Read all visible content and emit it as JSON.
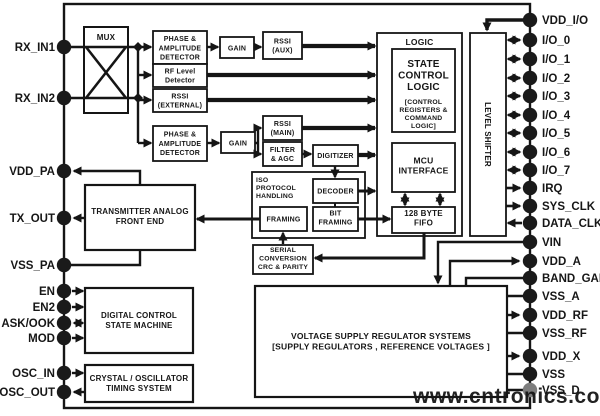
{
  "blocks": {
    "mux": [
      "MUX"
    ],
    "phase_amp_detector_top": [
      "PHASE &",
      "AMPLITUDE",
      "DETECTOR"
    ],
    "gain_top": [
      "GAIN"
    ],
    "rssi_aux": [
      "RSSI",
      "(AUX)"
    ],
    "rf_level_detector": [
      "RF Level",
      "Detector"
    ],
    "rssi_external": [
      "RSSI",
      "(EXTERNAL)"
    ],
    "phase_amp_detector_bottom": [
      "PHASE &",
      "AMPLITUDE",
      "DETECTOR"
    ],
    "gain_bottom": [
      "GAIN"
    ],
    "rssi_main": [
      "RSSI",
      "(MAIN)"
    ],
    "filter_agc": [
      "FILTER",
      "& AGC"
    ],
    "digitizer": [
      "DIGITIZER"
    ],
    "logic_title": [
      "LOGIC"
    ],
    "state_control_logic": [
      "STATE",
      "CONTROL",
      "LOGIC"
    ],
    "scl_sub": [
      "[CONTROL",
      "REGISTERS &",
      "COMMAND",
      "LOGIC]"
    ],
    "mcu_interface": [
      "MCU",
      "INTERFACE"
    ],
    "fifo": [
      "128 BYTE",
      "FIFO"
    ],
    "level_shifter": [
      "LEVEL SHIFTER"
    ],
    "iso_label": [
      "ISO",
      "PROTOCOL",
      "HANDLING"
    ],
    "decoder": [
      "DECODER"
    ],
    "bit_framing": [
      "BIT",
      "FRAMING"
    ],
    "framing": [
      "FRAMING"
    ],
    "serial_conversion": [
      "SERIAL",
      "CONVERSION",
      "CRC & PARITY"
    ],
    "tafe": [
      "TRANSMITTER ANALOG",
      "FRONT END"
    ],
    "dcsm": [
      "DIGITAL CONTROL",
      "STATE MACHINE"
    ],
    "xtal": [
      "CRYSTAL / OSCILLATOR",
      "TIMING SYSTEM"
    ],
    "vreg": [
      "VOLTAGE SUPPLY REGULATOR SYSTEMS",
      "[SUPPLY REGULATORS , REFERENCE VOLTAGES ]"
    ]
  },
  "pins": {
    "left": [
      "RX_IN1",
      "RX_IN2",
      "VDD_PA",
      "TX_OUT",
      "VSS_PA",
      "EN",
      "EN2",
      "ASK/OOK",
      "MOD",
      "OSC_IN",
      "OSC_OUT"
    ],
    "right": [
      "VDD_I/O",
      "I/O_0",
      "I/O_1",
      "I/O_2",
      "I/O_3",
      "I/O_4",
      "I/O_5",
      "I/O_6",
      "I/O_7",
      "IRQ",
      "SYS_CLK",
      "DATA_CLK",
      "VIN",
      "VDD_A",
      "BAND_GAP",
      "VSS_A",
      "VDD_RF",
      "VSS_RF",
      "VDD_X",
      "VSS",
      "VSS_D"
    ]
  },
  "watermark": {
    "text": "www.cntronics.com",
    "color": "#9ccb94"
  },
  "colors": {
    "line": "#151515",
    "background": "#ffffff",
    "pin_dot": "#1a1a1a",
    "pin_dot_muted": "#7d7d7d"
  }
}
